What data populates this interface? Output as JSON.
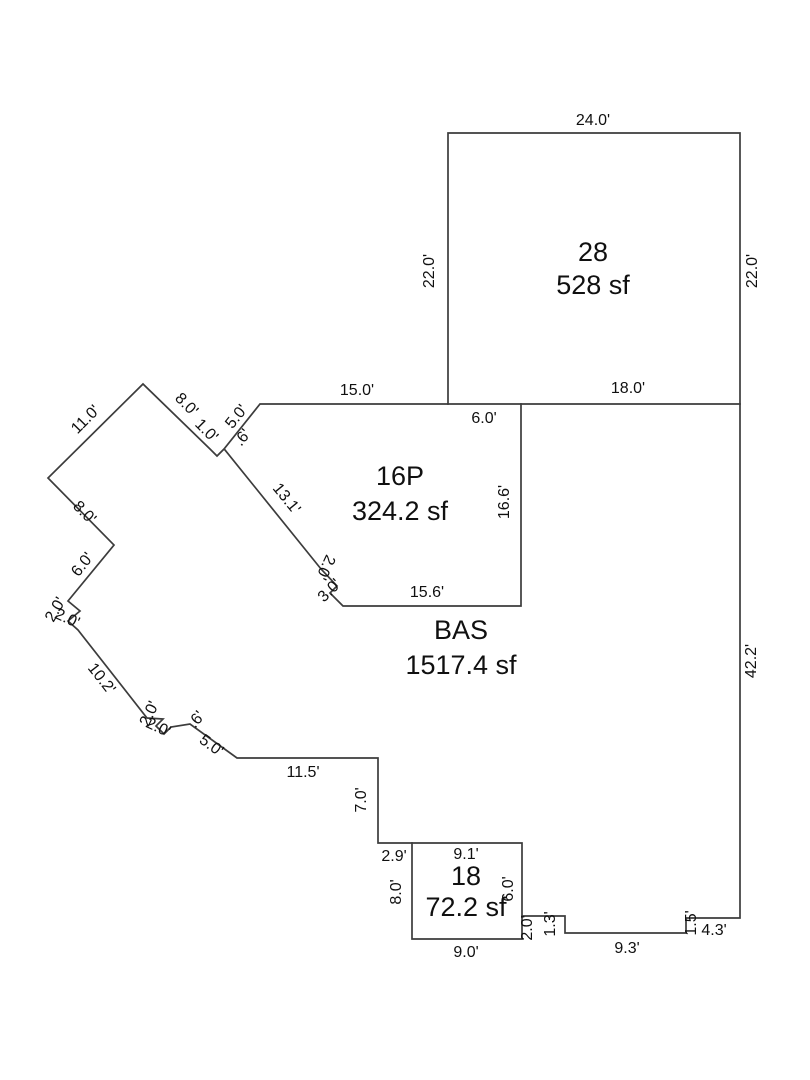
{
  "sketch": {
    "background_color": "#ffffff",
    "line_color": "#3c3c3c",
    "text_color": "#101010"
  },
  "areas": [
    {
      "code": "28",
      "size": "528 sf",
      "cx": 593,
      "code_y": 254,
      "size_y": 287
    },
    {
      "code": "16P",
      "size": "324.2 sf",
      "cx": 400,
      "code_y": 478,
      "size_y": 513
    },
    {
      "code": "BAS",
      "size": "1517.4 sf",
      "cx": 461,
      "code_y": 632,
      "size_y": 667
    },
    {
      "code": "18",
      "size": "72.2 sf",
      "cx": 466,
      "code_y": 878,
      "size_y": 909
    }
  ],
  "dimensions": [
    {
      "t": "24.0'",
      "x": 593,
      "y": 121,
      "r": 0
    },
    {
      "t": "22.0'",
      "x": 430,
      "y": 271,
      "r": -90
    },
    {
      "t": "22.0'",
      "x": 753,
      "y": 271,
      "r": -90
    },
    {
      "t": "18.0'",
      "x": 628,
      "y": 389,
      "r": 0
    },
    {
      "t": "6.0'",
      "x": 484,
      "y": 419,
      "r": 0
    },
    {
      "t": "15.0'",
      "x": 357,
      "y": 391,
      "r": 0
    },
    {
      "t": "11.0'",
      "x": 86,
      "y": 420,
      "r": -45
    },
    {
      "t": "8.0'",
      "x": 186,
      "y": 405,
      "r": 45
    },
    {
      "t": "1.0'",
      "x": 206,
      "y": 431,
      "r": 45,
      "s": 13
    },
    {
      "t": "5.0'",
      "x": 237,
      "y": 417,
      "r": -51,
      "s": 14
    },
    {
      "t": ".6'",
      "x": 243,
      "y": 438,
      "r": -51,
      "s": 12
    },
    {
      "t": "13.1'",
      "x": 286,
      "y": 499,
      "r": 51
    },
    {
      "t": "16.6'",
      "x": 505,
      "y": 502,
      "r": -90
    },
    {
      "t": "15.6'",
      "x": 427,
      "y": 593,
      "r": 0
    },
    {
      "t": "2.0'",
      "x": 325,
      "y": 567,
      "r": 115,
      "s": 13
    },
    {
      "t": "3.0'",
      "x": 330,
      "y": 591,
      "r": -45,
      "s": 13
    },
    {
      "t": "8.0'",
      "x": 84,
      "y": 513,
      "r": 45
    },
    {
      "t": "6.0'",
      "x": 83,
      "y": 565,
      "r": -52
    },
    {
      "t": "2.0'",
      "x": 56,
      "y": 610,
      "r": -60,
      "s": 13
    },
    {
      "t": "2.0'",
      "x": 67,
      "y": 619,
      "r": 25,
      "s": 13
    },
    {
      "t": "10.2'",
      "x": 101,
      "y": 679,
      "r": 52
    },
    {
      "t": "2.0'",
      "x": 150,
      "y": 714,
      "r": -65,
      "s": 13
    },
    {
      "t": "2.0'",
      "x": 158,
      "y": 728,
      "r": 25,
      "s": 13
    },
    {
      "t": ".6'",
      "x": 197,
      "y": 720,
      "r": -51,
      "s": 12
    },
    {
      "t": "5.0'",
      "x": 211,
      "y": 746,
      "r": 36
    },
    {
      "t": "11.5'",
      "x": 303,
      "y": 773,
      "r": 0
    },
    {
      "t": "7.0'",
      "x": 362,
      "y": 800,
      "r": -90
    },
    {
      "t": "2.9'",
      "x": 394,
      "y": 857,
      "r": 0
    },
    {
      "t": "9.1'",
      "x": 466,
      "y": 855,
      "r": 0
    },
    {
      "t": "8.0'",
      "x": 397,
      "y": 892,
      "r": -90
    },
    {
      "t": "6.0'",
      "x": 509,
      "y": 889,
      "r": -90
    },
    {
      "t": "9.0'",
      "x": 466,
      "y": 953,
      "r": 0
    },
    {
      "t": "2.0'",
      "x": 528,
      "y": 928,
      "r": -90,
      "s": 14
    },
    {
      "t": "1.3'",
      "x": 551,
      "y": 924,
      "r": -90,
      "s": 14
    },
    {
      "t": "9.3'",
      "x": 627,
      "y": 949,
      "r": 0
    },
    {
      "t": "1.5'",
      "x": 692,
      "y": 923,
      "r": -90,
      "s": 12
    },
    {
      "t": "4.3'",
      "x": 714,
      "y": 931,
      "r": 0
    },
    {
      "t": "42.2'",
      "x": 752,
      "y": 661,
      "r": -90
    }
  ]
}
